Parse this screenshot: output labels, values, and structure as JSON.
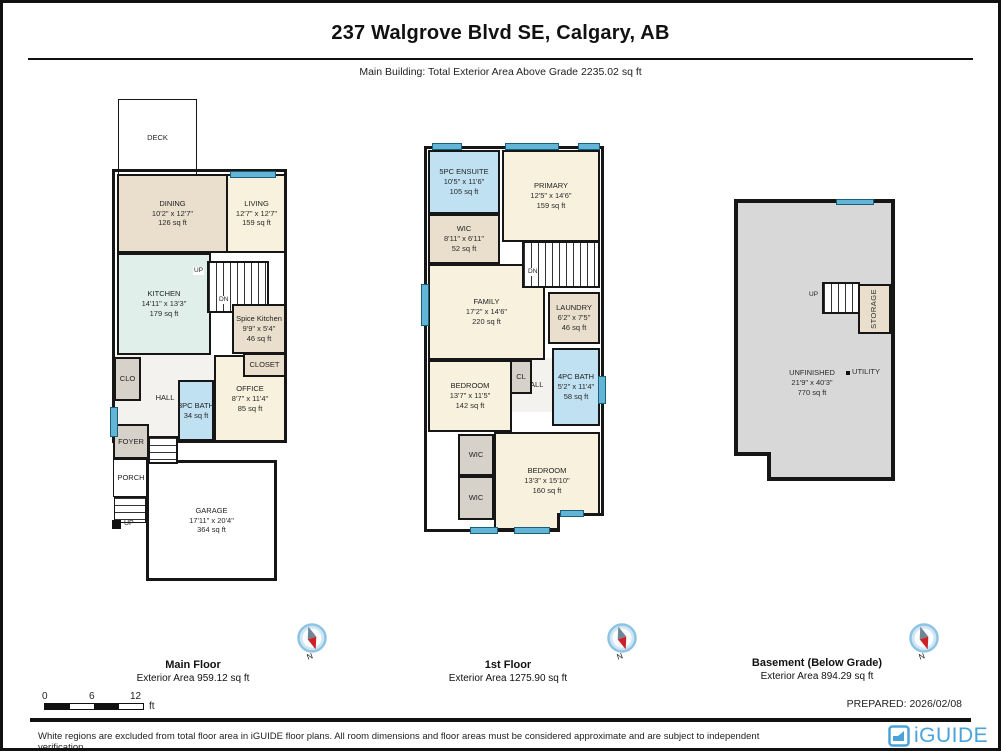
{
  "header": {
    "title": "237 Walgrove Blvd SE, Calgary, AB",
    "subtitle": "Main Building: Total Exterior Area Above Grade 2235.02 sq ft"
  },
  "floors": [
    {
      "name": "Main Floor",
      "area": "Exterior Area 959.12 sq ft",
      "rooms": {
        "deck": {
          "label": "DECK"
        },
        "dining": {
          "label": "DINING",
          "dims": "10'2\" x 12'7\"",
          "area": "126 sq ft"
        },
        "living": {
          "label": "LIVING",
          "dims": "12'7\" x 12'7\"",
          "area": "159 sq ft"
        },
        "kitchen": {
          "label": "KITCHEN",
          "dims": "14'11\" x 13'3\"",
          "area": "179 sq ft"
        },
        "spice": {
          "label": "Spice Kitchen",
          "dims": "9'9\" x 5'4\"",
          "area": "46 sq ft"
        },
        "clo": {
          "label": "CLO"
        },
        "hall": {
          "label": "HALL"
        },
        "bath": {
          "label": "3PC BATH",
          "area": "34 sq ft"
        },
        "office": {
          "label": "OFFICE",
          "dims": "8'7\" x 11'4\"",
          "area": "85 sq ft"
        },
        "closet": {
          "label": "CLOSET"
        },
        "foyer": {
          "label": "FOYER"
        },
        "porch": {
          "label": "PORCH"
        },
        "garage": {
          "label": "GARAGE",
          "dims": "17'11\" x 20'4\"",
          "area": "364 sq ft"
        },
        "up": "UP",
        "dn": "DN",
        "porch_up": "UP"
      }
    },
    {
      "name": "1st Floor",
      "area": "Exterior Area 1275.90 sq ft",
      "rooms": {
        "ensuite": {
          "label": "5PC ENSUITE",
          "dims": "10'5\" x 11'6\"",
          "area": "105 sq ft"
        },
        "primary": {
          "label": "PRIMARY",
          "dims": "12'5\" x 14'6\"",
          "area": "159 sq ft"
        },
        "wic": {
          "label": "WIC",
          "dims": "8'11\" x 6'11\"",
          "area": "52 sq ft"
        },
        "family": {
          "label": "FAMILY",
          "dims": "17'2\" x 14'6\"",
          "area": "220 sq ft"
        },
        "laundry": {
          "label": "LAUNDRY",
          "dims": "6'2\" x 7'5\"",
          "area": "46 sq ft"
        },
        "bedroom1": {
          "label": "BEDROOM",
          "dims": "13'7\" x 11'5\"",
          "area": "142 sq ft"
        },
        "cl": {
          "label": "CL"
        },
        "hall": {
          "label": "HALL"
        },
        "bath": {
          "label": "4PC BATH",
          "dims": "5'2\" x 11'4\"",
          "area": "58 sq ft"
        },
        "wic2": {
          "label": "WIC"
        },
        "wic3": {
          "label": "WIC"
        },
        "bedroom2": {
          "label": "BEDROOM",
          "dims": "13'3\" x 15'10\"",
          "area": "160 sq ft"
        },
        "dn": "DN"
      }
    },
    {
      "name": "Basement (Below Grade)",
      "area": "Exterior Area 894.29 sq ft",
      "rooms": {
        "unfinished": {
          "label": "UNFINISHED",
          "dims": "21'9\" x 40'3\"",
          "area": "770 sq ft"
        },
        "utility": {
          "label": "UTILITY"
        },
        "storage": {
          "label": "STORAGE"
        },
        "up": "UP"
      }
    }
  ],
  "compass": {
    "north": "N"
  },
  "scale_bar": {
    "ticks": [
      "0",
      "6",
      "12"
    ],
    "unit": "ft"
  },
  "footer": {
    "prepared": "PREPARED: 2026/02/08",
    "disclaimer": "White regions are excluded from total floor area in iGUIDE floor plans. All room dimensions and floor areas must be considered approximate and are subject to independent verification.",
    "brand": "iGUIDE"
  },
  "colors": {
    "wall": "#161616",
    "room_cream": "#f8f1dd",
    "room_beige": "#e9dfcc",
    "room_blue": "#bfe1f1",
    "room_teal": "#e0efe9",
    "basement_grey": "#d8d8d8",
    "window_blue": "#62b5d6",
    "brand_blue": "#4aa3d8"
  }
}
